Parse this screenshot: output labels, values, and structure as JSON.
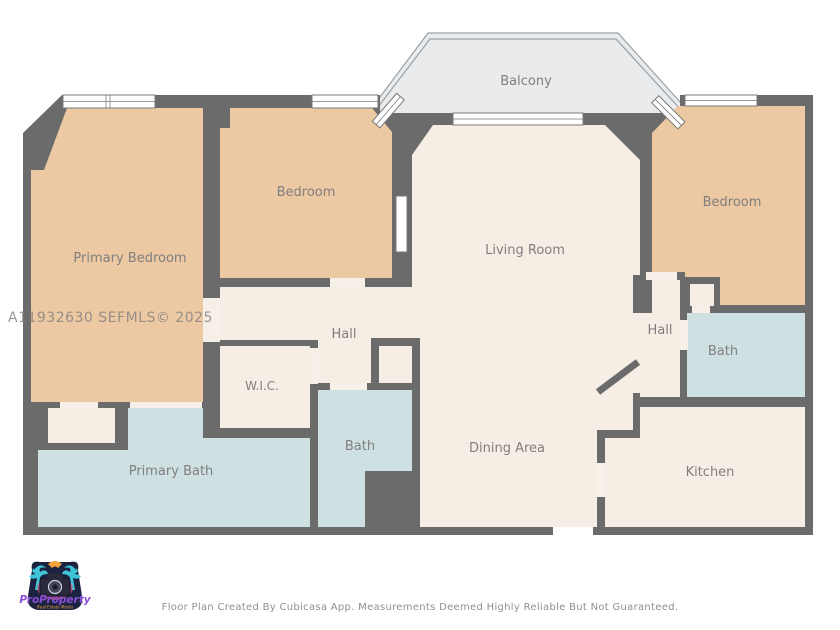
{
  "watermark": "A11932630  SEFMLS© 2025",
  "footer": "Floor Plan Created By Cubicasa App. Measurements Deemed Highly Reliable But Not Guaranteed.",
  "logo": {
    "brand": "ProProperty",
    "tagline": "Real Estate Media"
  },
  "rooms": [
    {
      "id": "balcony",
      "label": "Balcony"
    },
    {
      "id": "primary-bedroom",
      "label": "Primary Bedroom"
    },
    {
      "id": "bedroom-top",
      "label": "Bedroom"
    },
    {
      "id": "living-room",
      "label": "Living Room"
    },
    {
      "id": "bedroom-right",
      "label": "Bedroom"
    },
    {
      "id": "hall-left",
      "label": "Hall"
    },
    {
      "id": "hall-right",
      "label": "Hall"
    },
    {
      "id": "wic",
      "label": "W.I.C."
    },
    {
      "id": "bath-middle",
      "label": "Bath"
    },
    {
      "id": "bath-right",
      "label": "Bath"
    },
    {
      "id": "primary-bath",
      "label": "Primary Bath"
    },
    {
      "id": "dining-area",
      "label": "Dining Area"
    },
    {
      "id": "kitchen",
      "label": "Kitchen"
    }
  ],
  "colors": {
    "wall": "#6b6b6b",
    "room_warm": "#ecc9a2",
    "room_neutral": "#f6ede4",
    "room_wet": "#cfe0e2",
    "balcony": "#e9ebec",
    "label": "#7f7f7f"
  }
}
